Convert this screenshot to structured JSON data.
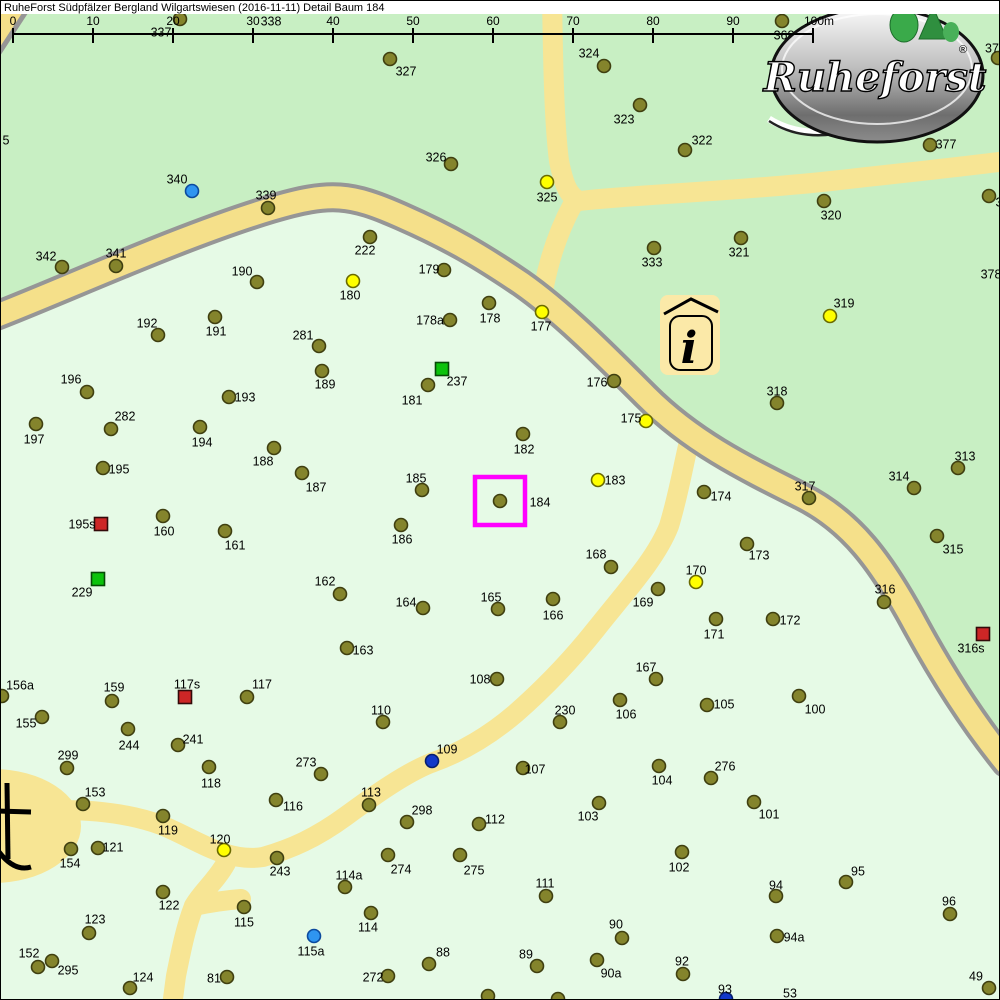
{
  "header": {
    "title": "RuheForst Südpfälzer Bergland Wilgartswiesen (2016-11-11) Detail  Baum 184"
  },
  "scale_bar": {
    "ticks": [
      "0",
      "10",
      "20",
      "30",
      "40",
      "50",
      "60",
      "70",
      "80",
      "90",
      "100m"
    ],
    "x0": 12,
    "step": 80,
    "line_y": 33
  },
  "logo": {
    "brand": "Ruheforst",
    "registered": "®"
  },
  "info_icon": {
    "glyph": "i"
  },
  "colors": {
    "forest_upper": "#c8efc3",
    "forest_lower": "#e6fae6",
    "road_fill": "#f5e08a",
    "path_fill": "#f7e594",
    "road_border": "#969696",
    "highlight": "#ff00ff"
  },
  "map": {
    "highlight": {
      "tree_id": "184",
      "x": 474,
      "y": 476,
      "w": 50,
      "h": 48
    },
    "marker_styles": {
      "o": {
        "fill": "#84842c",
        "stroke": "#3f3f10",
        "shape": "circle",
        "meaning": "tree"
      },
      "y": {
        "fill": "#ffff00",
        "stroke": "#6a6a00",
        "shape": "circle",
        "meaning": "tree-yellow"
      },
      "b": {
        "fill": "#2f95f0",
        "stroke": "#0c4a9e",
        "shape": "circle",
        "meaning": "tree-light-blue"
      },
      "B": {
        "fill": "#1238c8",
        "stroke": "#071e6e",
        "shape": "circle",
        "meaning": "tree-dark-blue"
      },
      "r": {
        "fill": "#cd2626",
        "stroke": "#330a0a",
        "shape": "square",
        "meaning": "marker-red-square"
      },
      "g": {
        "fill": "#0cc20c",
        "stroke": "#064a06",
        "shape": "square",
        "meaning": "marker-green-square"
      }
    },
    "tree_fields": [
      "id",
      "type",
      "x",
      "y",
      "label_x",
      "label_y"
    ],
    "trees": [
      [
        "337",
        "o",
        179,
        18,
        160,
        31
      ],
      [
        "338",
        "n",
        null,
        null,
        270,
        20
      ],
      [
        "368",
        "o",
        781,
        20,
        783,
        34
      ],
      [
        "37",
        "o",
        997,
        57,
        991,
        47
      ],
      [
        "327",
        "o",
        389,
        58,
        405,
        70
      ],
      [
        "324",
        "o",
        603,
        65,
        588,
        52
      ],
      [
        "323",
        "o",
        639,
        104,
        623,
        118
      ],
      [
        "377",
        "o",
        929,
        144,
        945,
        143
      ],
      [
        "322",
        "o",
        684,
        149,
        701,
        139
      ],
      [
        "326",
        "o",
        450,
        163,
        435,
        156
      ],
      [
        "325",
        "y",
        546,
        181,
        546,
        196
      ],
      [
        "340",
        "b",
        191,
        190,
        176,
        178
      ],
      [
        "339",
        "o",
        267,
        207,
        265,
        194
      ],
      [
        "320",
        "o",
        823,
        200,
        830,
        214
      ],
      [
        "3",
        "o",
        988,
        195,
        998,
        201
      ],
      [
        "342",
        "o",
        61,
        266,
        45,
        255
      ],
      [
        "341",
        "o",
        115,
        265,
        115,
        252
      ],
      [
        "222",
        "o",
        369,
        236,
        364,
        249
      ],
      [
        "190",
        "o",
        256,
        281,
        241,
        270
      ],
      [
        "179",
        "o",
        443,
        269,
        428,
        268
      ],
      [
        "321",
        "o",
        740,
        237,
        738,
        251
      ],
      [
        "333",
        "o",
        653,
        247,
        651,
        261
      ],
      [
        "378",
        "n",
        null,
        null,
        990,
        273
      ],
      [
        "180",
        "y",
        352,
        280,
        349,
        294
      ],
      [
        "178",
        "o",
        488,
        302,
        489,
        317
      ],
      [
        "177",
        "y",
        541,
        311,
        540,
        325
      ],
      [
        "178a",
        "o",
        449,
        319,
        429,
        319
      ],
      [
        "192",
        "o",
        157,
        334,
        146,
        322
      ],
      [
        "191",
        "o",
        214,
        316,
        215,
        330
      ],
      [
        "281",
        "o",
        318,
        345,
        302,
        334
      ],
      [
        "319",
        "y",
        829,
        315,
        843,
        302
      ],
      [
        "237",
        "g",
        441,
        368,
        456,
        380
      ],
      [
        "189",
        "o",
        321,
        370,
        324,
        383
      ],
      [
        "176",
        "o",
        613,
        380,
        596,
        381
      ],
      [
        "318",
        "o",
        776,
        402,
        776,
        390
      ],
      [
        "196",
        "o",
        86,
        391,
        70,
        378
      ],
      [
        "181",
        "o",
        427,
        384,
        411,
        399
      ],
      [
        "193",
        "o",
        228,
        396,
        244,
        396
      ],
      [
        "282",
        "o",
        110,
        428,
        124,
        415
      ],
      [
        "197",
        "o",
        35,
        423,
        33,
        438
      ],
      [
        "194",
        "o",
        199,
        426,
        201,
        441
      ],
      [
        "175",
        "y",
        645,
        420,
        630,
        417
      ],
      [
        "188",
        "o",
        273,
        447,
        262,
        460
      ],
      [
        "182",
        "o",
        522,
        433,
        523,
        448
      ],
      [
        "187",
        "o",
        301,
        472,
        315,
        486
      ],
      [
        "195",
        "o",
        102,
        467,
        118,
        468
      ],
      [
        "313",
        "o",
        957,
        467,
        964,
        455
      ],
      [
        "314",
        "o",
        913,
        487,
        898,
        475
      ],
      [
        "317",
        "o",
        808,
        497,
        804,
        485
      ],
      [
        "183",
        "y",
        597,
        479,
        614,
        479
      ],
      [
        "185",
        "o",
        421,
        489,
        415,
        477
      ],
      [
        "184",
        "o",
        499,
        500,
        539,
        501
      ],
      [
        "174",
        "o",
        703,
        491,
        720,
        495
      ],
      [
        "195s",
        "r",
        100,
        523,
        81,
        523
      ],
      [
        "160",
        "o",
        162,
        515,
        163,
        530
      ],
      [
        "161",
        "o",
        224,
        530,
        234,
        544
      ],
      [
        "186",
        "o",
        400,
        524,
        401,
        538
      ],
      [
        "168",
        "o",
        610,
        566,
        595,
        553
      ],
      [
        "173",
        "o",
        746,
        543,
        758,
        554
      ],
      [
        "315",
        "o",
        936,
        535,
        952,
        548
      ],
      [
        "170",
        "y",
        695,
        581,
        695,
        569
      ],
      [
        "229",
        "g",
        97,
        578,
        81,
        591
      ],
      [
        "162",
        "o",
        339,
        593,
        324,
        580
      ],
      [
        "316",
        "o",
        883,
        601,
        884,
        588
      ],
      [
        "169",
        "o",
        657,
        588,
        642,
        601
      ],
      [
        "164",
        "o",
        422,
        607,
        405,
        601
      ],
      [
        "165",
        "o",
        497,
        608,
        490,
        596
      ],
      [
        "166",
        "o",
        552,
        598,
        552,
        614
      ],
      [
        "171",
        "o",
        715,
        618,
        713,
        633
      ],
      [
        "172",
        "o",
        772,
        618,
        789,
        619
      ],
      [
        "316s",
        "r",
        982,
        633,
        970,
        647
      ],
      [
        "167",
        "o",
        655,
        678,
        645,
        666
      ],
      [
        "163",
        "o",
        346,
        647,
        362,
        649
      ],
      [
        "156a",
        "o",
        1,
        695,
        19,
        684
      ],
      [
        "159",
        "o",
        111,
        700,
        113,
        686
      ],
      [
        "117s",
        "r",
        184,
        696,
        186,
        683
      ],
      [
        "117",
        "o",
        246,
        696,
        261,
        683
      ],
      [
        "108",
        "o",
        496,
        678,
        479,
        678
      ],
      [
        "105",
        "o",
        706,
        704,
        723,
        703
      ],
      [
        "106",
        "o",
        619,
        699,
        625,
        713
      ],
      [
        "230",
        "o",
        559,
        721,
        564,
        709
      ],
      [
        "100",
        "o",
        798,
        695,
        814,
        708
      ],
      [
        "155",
        "o",
        41,
        716,
        25,
        722
      ],
      [
        "244",
        "o",
        127,
        728,
        128,
        744
      ],
      [
        "241",
        "o",
        177,
        744,
        192,
        738
      ],
      [
        "110",
        "o",
        382,
        721,
        380,
        709
      ],
      [
        "299",
        "o",
        66,
        767,
        67,
        754
      ],
      [
        "118",
        "o",
        208,
        766,
        210,
        782
      ],
      [
        "107",
        "o",
        522,
        767,
        534,
        768
      ],
      [
        "104",
        "o",
        658,
        765,
        661,
        779
      ],
      [
        "276",
        "o",
        710,
        777,
        724,
        765
      ],
      [
        "109",
        "B",
        431,
        760,
        446,
        748
      ],
      [
        "273",
        "o",
        320,
        773,
        305,
        761
      ],
      [
        "153",
        "o",
        82,
        803,
        94,
        791
      ],
      [
        "103",
        "o",
        598,
        802,
        587,
        815
      ],
      [
        "101",
        "o",
        753,
        801,
        768,
        813
      ],
      [
        "113",
        "o",
        368,
        804,
        370,
        791
      ],
      [
        "116",
        "o",
        275,
        799,
        292,
        805
      ],
      [
        "119",
        "o",
        162,
        815,
        167,
        829
      ],
      [
        "298",
        "o",
        406,
        821,
        421,
        809
      ],
      [
        "112",
        "o",
        478,
        823,
        494,
        818
      ],
      [
        "120",
        "y",
        223,
        849,
        219,
        838
      ],
      [
        "121",
        "o",
        97,
        847,
        112,
        846
      ],
      [
        "154",
        "o",
        70,
        848,
        69,
        862
      ],
      [
        "102",
        "o",
        681,
        851,
        678,
        866
      ],
      [
        "243",
        "o",
        276,
        857,
        279,
        870
      ],
      [
        "274",
        "o",
        387,
        854,
        400,
        868
      ],
      [
        "275",
        "o",
        459,
        854,
        473,
        869
      ],
      [
        "95",
        "o",
        845,
        881,
        857,
        870
      ],
      [
        "94",
        "o",
        775,
        895,
        775,
        884
      ],
      [
        "111",
        "o",
        545,
        895,
        544,
        882
      ],
      [
        "114a",
        "o",
        344,
        886,
        348,
        874
      ],
      [
        "122",
        "o",
        162,
        891,
        168,
        904
      ],
      [
        "115",
        "o",
        243,
        906,
        243,
        921
      ],
      [
        "96",
        "o",
        949,
        913,
        948,
        900
      ],
      [
        "90",
        "o",
        621,
        937,
        615,
        923
      ],
      [
        "123",
        "o",
        88,
        932,
        94,
        918
      ],
      [
        "94a",
        "o",
        776,
        935,
        793,
        936
      ],
      [
        "115a",
        "b",
        313,
        935,
        310,
        950
      ],
      [
        "152",
        "o",
        37,
        966,
        28,
        952
      ],
      [
        "295",
        "o",
        51,
        960,
        67,
        969
      ],
      [
        "89",
        "o",
        536,
        965,
        525,
        953
      ],
      [
        "90a",
        "o",
        596,
        959,
        610,
        972
      ],
      [
        "92",
        "o",
        682,
        973,
        681,
        960
      ],
      [
        "88",
        "o",
        428,
        963,
        442,
        951
      ],
      [
        "272",
        "o",
        387,
        975,
        372,
        976
      ],
      [
        "124",
        "o",
        129,
        987,
        142,
        976
      ],
      [
        "81",
        "o",
        226,
        976,
        213,
        977
      ],
      [
        "114",
        "o",
        370,
        912,
        367,
        926
      ],
      [
        "93",
        "B",
        725,
        998,
        724,
        988
      ],
      [
        "49",
        "o",
        988,
        987,
        975,
        975
      ],
      [
        "53",
        "n",
        null,
        null,
        789,
        992
      ],
      [
        "5",
        "n",
        null,
        null,
        5,
        139
      ],
      [
        "",
        "o",
        557,
        998,
        null,
        null
      ],
      [
        "",
        "o",
        487,
        995,
        null,
        null
      ]
    ]
  }
}
